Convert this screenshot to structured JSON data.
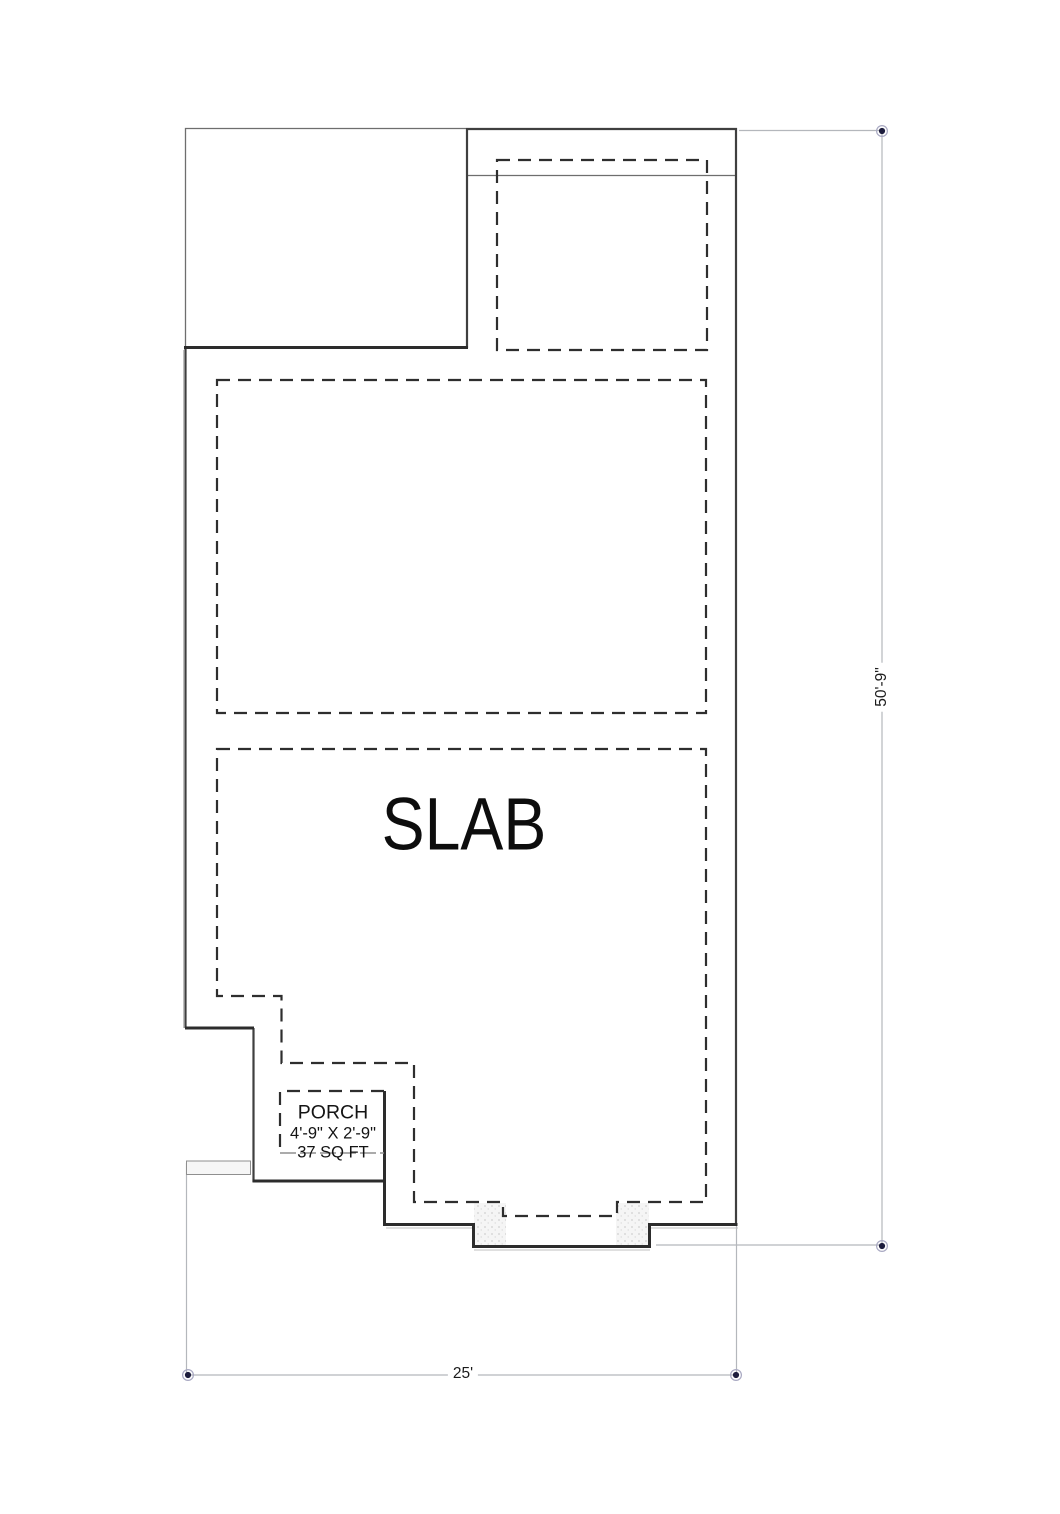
{
  "plan": {
    "slab_label": "SLAB",
    "porch": {
      "name": "PORCH",
      "size": "4'-9\" X 2'-9\"",
      "area": "37 SQ FT"
    },
    "dims": {
      "height": "50'-9\"",
      "width": "25'"
    }
  },
  "colors": {
    "wall_heavy": "#2c2c2c",
    "wall_medium": "#3f3f3f",
    "wall_thin": "#6e6e6e",
    "slab_dashed": "#2e2e2e",
    "dimension_line": "#b4b7bc",
    "marker_dot": "#1d1d3d",
    "stipple": "#cfcfcf",
    "background": "#ffffff"
  }
}
